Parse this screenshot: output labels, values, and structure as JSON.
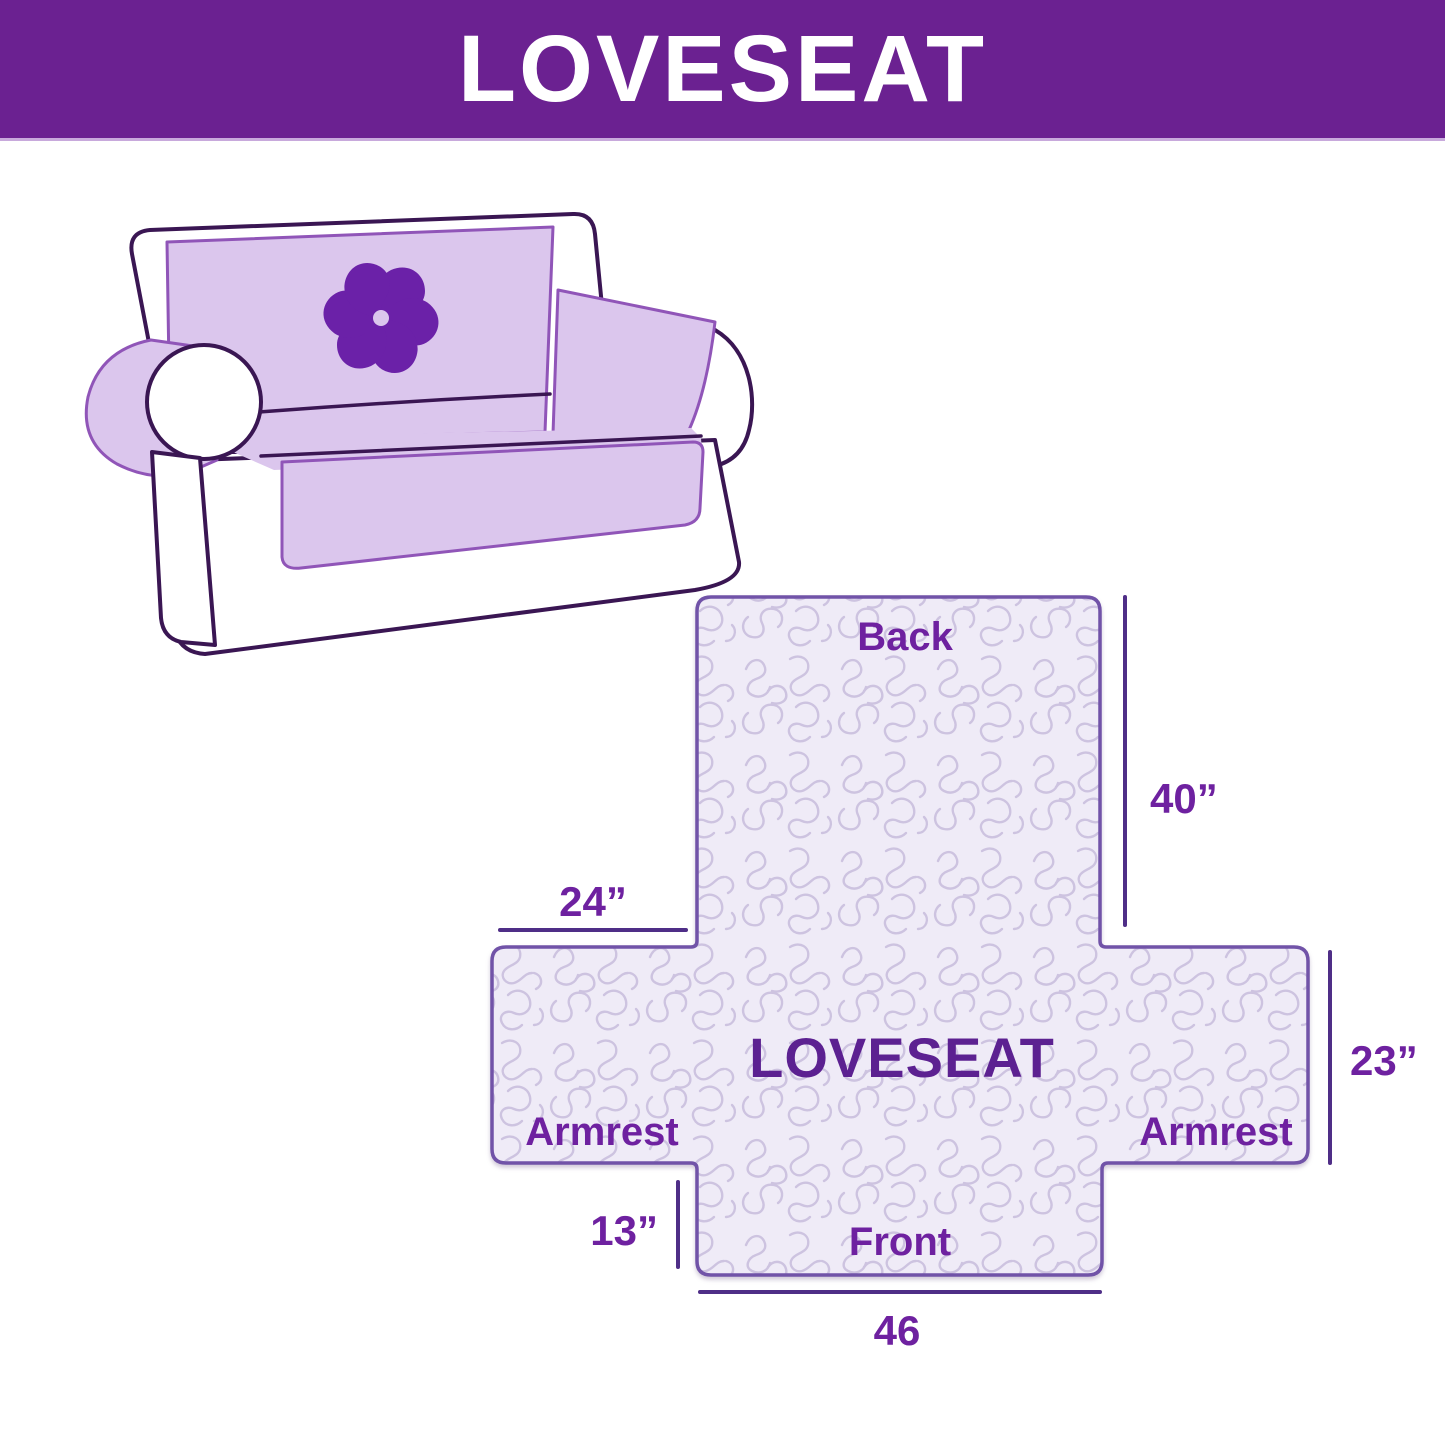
{
  "header": {
    "title": "LOVESEAT",
    "bg_color": "#6B2191",
    "text_color": "#FFFFFF"
  },
  "illustration": {
    "subject": "loveseat sofa with quilted cover",
    "logo_icon": "pinwheel-flower",
    "cover_color": "#DBC6ED",
    "outline_color": "#3A1653",
    "logo_color": "#6B21A8"
  },
  "diagram": {
    "labels": {
      "back": "Back",
      "center": "LOVESEAT",
      "armrest_left": "Armrest",
      "armrest_right": "Armrest",
      "front": "Front"
    },
    "dimensions": {
      "back_height": "40”",
      "armrest_width": "24”",
      "side_depth": "23”",
      "front_drop": "13”",
      "front_width": "46"
    },
    "colors": {
      "fill": "#EFEBF7",
      "pattern": "#CDC3E0",
      "border": "#7153A8",
      "dimension_line": "#4F2E87",
      "label": "#6E21A0"
    }
  }
}
